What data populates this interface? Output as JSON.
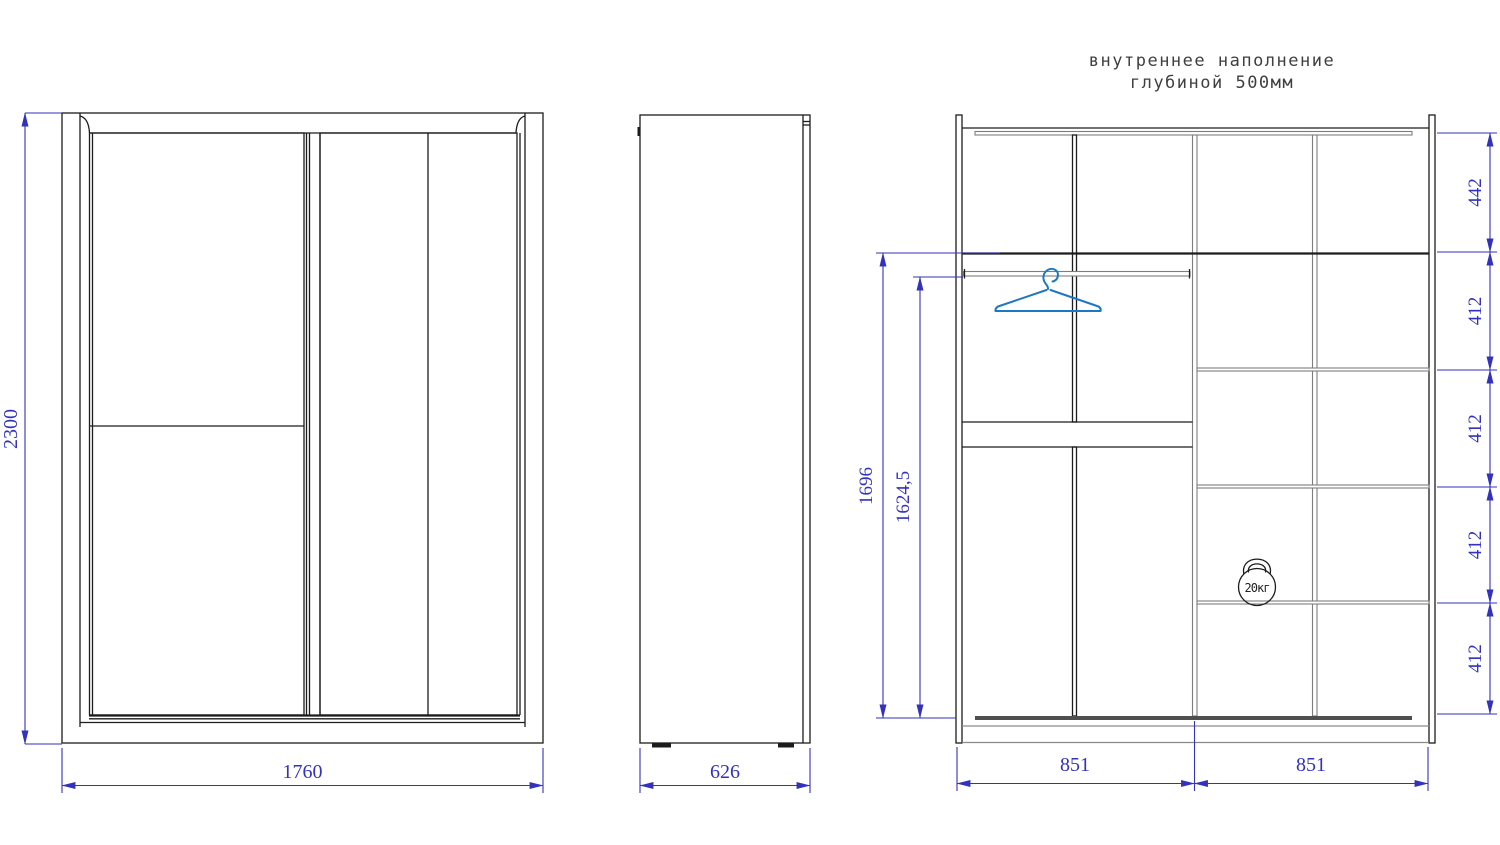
{
  "title": {
    "line1": "внутреннее наполнение",
    "line2": "глубиной 500мм"
  },
  "front_view": {
    "height_label": "2300",
    "width_label": "1760"
  },
  "side_view": {
    "depth_label": "626"
  },
  "internal_view": {
    "shelf_labels": [
      "442",
      "412",
      "412",
      "412",
      "412"
    ],
    "total_height_label": "1696",
    "rod_height_label": "1624,5",
    "left_section_width_label": "851",
    "right_section_width_label": "851",
    "kettlebell_label": "20кг"
  },
  "colors": {
    "line_black": "#1c1c1c",
    "shelf_gray": "#8a8a8a",
    "dimension_blue": "#3232bc",
    "hanger_blue": "#1d78c4"
  }
}
